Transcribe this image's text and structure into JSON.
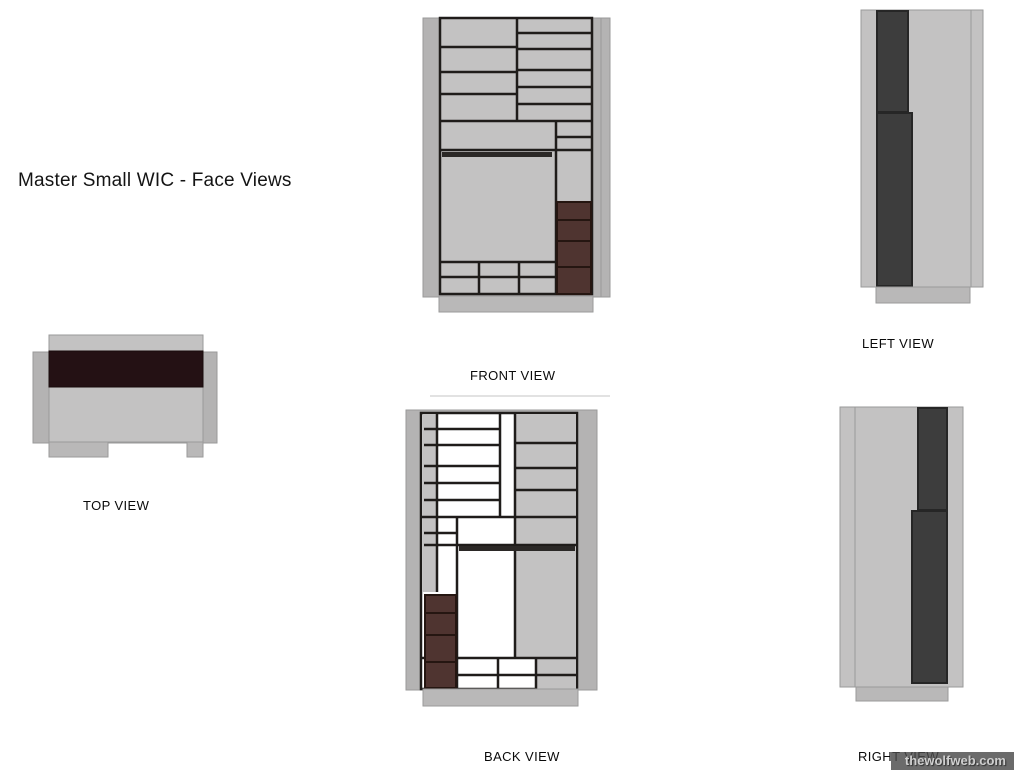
{
  "title": "Master Small WIC - Face Views",
  "watermark": "thewolfweb.com",
  "colors": {
    "face": "#c3c2c2",
    "bg": "#b4b3b3",
    "base": "#b9b8b8",
    "edge": "#9a9a9a",
    "faint": "#d9d9d9",
    "ink": "#1f1c1a",
    "brown": "#4f3430",
    "brownDark": "#251611",
    "darkBar": "#3d3d3d",
    "darkBarStroke": "#262626",
    "band": "#241114",
    "bandStroke": "#190c0c",
    "rod": "#2b2826",
    "white": "#ffffff"
  },
  "views": [
    {
      "id": "front",
      "label": "FRONT VIEW",
      "label_x": 470,
      "label_y": 368,
      "shapes": [
        {
          "t": "r",
          "n": "back-panel",
          "x": 423,
          "y": 18,
          "w": 187,
          "h": 279,
          "f": "bg",
          "s": "edge",
          "sw": 1
        },
        {
          "t": "l",
          "n": "panel-edge",
          "x1": 601,
          "y1": 18,
          "x2": 601,
          "y2": 297,
          "c": "edge",
          "sw": 1
        },
        {
          "t": "r",
          "n": "cabinet-face",
          "x": 440,
          "y": 18,
          "w": 152,
          "h": 276,
          "f": "face",
          "s": "ink",
          "sw": 2.5
        },
        {
          "t": "l",
          "x1": 517,
          "y1": 18,
          "x2": 517,
          "y2": 121
        },
        {
          "t": "l",
          "x1": 440,
          "y1": 47,
          "x2": 517,
          "y2": 47
        },
        {
          "t": "l",
          "x1": 440,
          "y1": 72,
          "x2": 517,
          "y2": 72
        },
        {
          "t": "l",
          "x1": 440,
          "y1": 94,
          "x2": 517,
          "y2": 94
        },
        {
          "t": "l",
          "x1": 517,
          "y1": 33,
          "x2": 592,
          "y2": 33
        },
        {
          "t": "l",
          "x1": 517,
          "y1": 49,
          "x2": 592,
          "y2": 49
        },
        {
          "t": "l",
          "x1": 517,
          "y1": 70,
          "x2": 592,
          "y2": 70
        },
        {
          "t": "l",
          "x1": 517,
          "y1": 87,
          "x2": 592,
          "y2": 87
        },
        {
          "t": "l",
          "x1": 517,
          "y1": 104,
          "x2": 592,
          "y2": 104
        },
        {
          "t": "l",
          "x1": 440,
          "y1": 121,
          "x2": 592,
          "y2": 121
        },
        {
          "t": "l",
          "x1": 440,
          "y1": 150,
          "x2": 592,
          "y2": 150
        },
        {
          "t": "l",
          "x1": 556,
          "y1": 121,
          "x2": 556,
          "y2": 294
        },
        {
          "t": "l",
          "x1": 556,
          "y1": 137,
          "x2": 592,
          "y2": 137
        },
        {
          "t": "r",
          "n": "closet-rod",
          "x": 442,
          "y": 152,
          "w": 110,
          "h": 5,
          "f": "rod"
        },
        {
          "t": "l",
          "x1": 440,
          "y1": 262,
          "x2": 556,
          "y2": 262
        },
        {
          "t": "l",
          "x1": 479,
          "y1": 262,
          "x2": 479,
          "y2": 294
        },
        {
          "t": "l",
          "x1": 519,
          "y1": 262,
          "x2": 519,
          "y2": 294
        },
        {
          "t": "l",
          "x1": 440,
          "y1": 277,
          "x2": 556,
          "y2": 277
        },
        {
          "t": "r",
          "n": "drawer",
          "x": 557,
          "y": 202,
          "w": 34,
          "h": 18,
          "f": "brown",
          "s": "brownDark",
          "sw": 2
        },
        {
          "t": "r",
          "n": "drawer",
          "x": 557,
          "y": 220,
          "w": 34,
          "h": 21,
          "f": "brown",
          "s": "brownDark",
          "sw": 2
        },
        {
          "t": "r",
          "n": "drawer",
          "x": 557,
          "y": 241,
          "w": 34,
          "h": 26,
          "f": "brown",
          "s": "brownDark",
          "sw": 2
        },
        {
          "t": "r",
          "n": "drawer",
          "x": 557,
          "y": 267,
          "w": 34,
          "h": 27,
          "f": "brown",
          "s": "brownDark",
          "sw": 2
        },
        {
          "t": "r",
          "n": "toe-base",
          "x": 439,
          "y": 296,
          "w": 154,
          "h": 16,
          "f": "base",
          "s": "edge",
          "sw": 1
        }
      ]
    },
    {
      "id": "top",
      "label": "TOP VIEW",
      "label_x": 83,
      "label_y": 498,
      "shapes": [
        {
          "t": "r",
          "n": "back-panel",
          "x": 33,
          "y": 352,
          "w": 184,
          "h": 91,
          "f": "bg",
          "s": "edge",
          "sw": 1
        },
        {
          "t": "r",
          "n": "cabinet-face",
          "x": 49,
          "y": 335,
          "w": 154,
          "h": 107,
          "f": "face",
          "s": "edge",
          "sw": 1
        },
        {
          "t": "r",
          "n": "dark-band",
          "x": 49,
          "y": 351,
          "w": 154,
          "h": 36,
          "f": "band",
          "s": "bandStroke",
          "sw": 1
        },
        {
          "t": "r",
          "n": "foot",
          "x": 49,
          "y": 442,
          "w": 59,
          "h": 15,
          "f": "base",
          "s": "edge",
          "sw": 1
        },
        {
          "t": "r",
          "n": "foot",
          "x": 187,
          "y": 442,
          "w": 16,
          "h": 15,
          "f": "base",
          "s": "edge",
          "sw": 1
        }
      ]
    },
    {
      "id": "left",
      "label": "LEFT VIEW",
      "label_x": 862,
      "label_y": 336,
      "shapes": [
        {
          "t": "r",
          "n": "side-panel",
          "x": 861,
          "y": 10,
          "w": 122,
          "h": 277,
          "f": "face",
          "s": "edge",
          "sw": 1
        },
        {
          "t": "l",
          "n": "panel-edge",
          "x1": 971,
          "y1": 10,
          "x2": 971,
          "y2": 287,
          "c": "edge",
          "sw": 1
        },
        {
          "t": "r",
          "n": "dark-column",
          "x": 877,
          "y": 11,
          "w": 31,
          "h": 101,
          "f": "darkBar",
          "s": "darkBarStroke",
          "sw": 2
        },
        {
          "t": "r",
          "n": "dark-column",
          "x": 877,
          "y": 113,
          "w": 35,
          "h": 173,
          "f": "darkBar",
          "s": "darkBarStroke",
          "sw": 2
        },
        {
          "t": "r",
          "n": "toe-base",
          "x": 876,
          "y": 287,
          "w": 94,
          "h": 16,
          "f": "base",
          "s": "edge",
          "sw": 1
        }
      ]
    },
    {
      "id": "back",
      "label": "BACK VIEW",
      "label_x": 484,
      "label_y": 749,
      "shapes": [
        {
          "t": "l",
          "n": "faint-top-edge",
          "x1": 430,
          "y1": 396,
          "x2": 610,
          "y2": 396,
          "c": "faint",
          "sw": 1.5
        },
        {
          "t": "r",
          "n": "back-panel",
          "x": 406,
          "y": 410,
          "w": 191,
          "h": 280,
          "f": "bg",
          "s": "edge",
          "sw": 1
        },
        {
          "t": "r",
          "n": "cabinet-face",
          "x": 421,
          "y": 413,
          "w": 156,
          "h": 276,
          "f": "white",
          "s": "ink",
          "sw": 2.5
        },
        {
          "t": "r",
          "n": "side-strip",
          "x": 423,
          "y": 414,
          "w": 15,
          "h": 178,
          "f": "face"
        },
        {
          "t": "r",
          "n": "back-panel-section",
          "x": 515,
          "y": 414,
          "w": 61,
          "h": 244,
          "f": "face"
        },
        {
          "t": "r",
          "n": "back-panel-section",
          "x": 536,
          "y": 658,
          "w": 40,
          "h": 31,
          "f": "face"
        },
        {
          "t": "l",
          "x1": 437,
          "y1": 413,
          "x2": 437,
          "y2": 592
        },
        {
          "t": "l",
          "x1": 500,
          "y1": 413,
          "x2": 500,
          "y2": 517
        },
        {
          "t": "l",
          "x1": 515,
          "y1": 413,
          "x2": 515,
          "y2": 658
        },
        {
          "t": "l",
          "x1": 457,
          "y1": 517,
          "x2": 457,
          "y2": 689
        },
        {
          "t": "l",
          "x1": 424,
          "y1": 429,
          "x2": 500,
          "y2": 429
        },
        {
          "t": "l",
          "x1": 424,
          "y1": 445,
          "x2": 500,
          "y2": 445
        },
        {
          "t": "l",
          "x1": 424,
          "y1": 466,
          "x2": 500,
          "y2": 466
        },
        {
          "t": "l",
          "x1": 424,
          "y1": 483,
          "x2": 500,
          "y2": 483
        },
        {
          "t": "l",
          "x1": 424,
          "y1": 500,
          "x2": 500,
          "y2": 500
        },
        {
          "t": "l",
          "x1": 515,
          "y1": 443,
          "x2": 576,
          "y2": 443
        },
        {
          "t": "l",
          "x1": 515,
          "y1": 468,
          "x2": 576,
          "y2": 468
        },
        {
          "t": "l",
          "x1": 515,
          "y1": 490,
          "x2": 576,
          "y2": 490
        },
        {
          "t": "l",
          "x1": 421,
          "y1": 517,
          "x2": 577,
          "y2": 517
        },
        {
          "t": "l",
          "x1": 424,
          "y1": 533,
          "x2": 457,
          "y2": 533
        },
        {
          "t": "l",
          "x1": 424,
          "y1": 545,
          "x2": 577,
          "y2": 545
        },
        {
          "t": "r",
          "n": "closet-rod",
          "x": 459,
          "y": 546,
          "w": 116,
          "h": 5,
          "f": "rod"
        },
        {
          "t": "l",
          "x1": 421,
          "y1": 658,
          "x2": 577,
          "y2": 658
        },
        {
          "t": "l",
          "x1": 498,
          "y1": 658,
          "x2": 498,
          "y2": 689
        },
        {
          "t": "l",
          "x1": 536,
          "y1": 658,
          "x2": 536,
          "y2": 689
        },
        {
          "t": "l",
          "x1": 457,
          "y1": 675,
          "x2": 577,
          "y2": 675
        },
        {
          "t": "r",
          "n": "drawer",
          "x": 425,
          "y": 595,
          "w": 31,
          "h": 18,
          "f": "brown",
          "s": "brownDark",
          "sw": 2
        },
        {
          "t": "r",
          "n": "drawer",
          "x": 425,
          "y": 613,
          "w": 31,
          "h": 22,
          "f": "brown",
          "s": "brownDark",
          "sw": 2
        },
        {
          "t": "r",
          "n": "drawer",
          "x": 425,
          "y": 635,
          "w": 31,
          "h": 27,
          "f": "brown",
          "s": "brownDark",
          "sw": 2
        },
        {
          "t": "r",
          "n": "drawer",
          "x": 425,
          "y": 662,
          "w": 31,
          "h": 26,
          "f": "brown",
          "s": "brownDark",
          "sw": 2
        },
        {
          "t": "r",
          "n": "toe-base",
          "x": 423,
          "y": 689,
          "w": 155,
          "h": 17,
          "f": "base",
          "s": "edge",
          "sw": 1
        }
      ]
    },
    {
      "id": "right",
      "label": "RIGHT VIEW",
      "label_x": 858,
      "label_y": 749,
      "shapes": [
        {
          "t": "r",
          "n": "side-panel",
          "x": 840,
          "y": 407,
          "w": 123,
          "h": 280,
          "f": "face",
          "s": "edge",
          "sw": 1
        },
        {
          "t": "l",
          "n": "panel-edge",
          "x1": 855,
          "y1": 407,
          "x2": 855,
          "y2": 687,
          "c": "edge",
          "sw": 1
        },
        {
          "t": "r",
          "n": "dark-column",
          "x": 918,
          "y": 408,
          "w": 29,
          "h": 102,
          "f": "darkBar",
          "s": "darkBarStroke",
          "sw": 2
        },
        {
          "t": "r",
          "n": "dark-column",
          "x": 912,
          "y": 511,
          "w": 35,
          "h": 172,
          "f": "darkBar",
          "s": "darkBarStroke",
          "sw": 2
        },
        {
          "t": "r",
          "n": "toe-base",
          "x": 856,
          "y": 687,
          "w": 92,
          "h": 14,
          "f": "base",
          "s": "edge",
          "sw": 1
        }
      ]
    }
  ]
}
